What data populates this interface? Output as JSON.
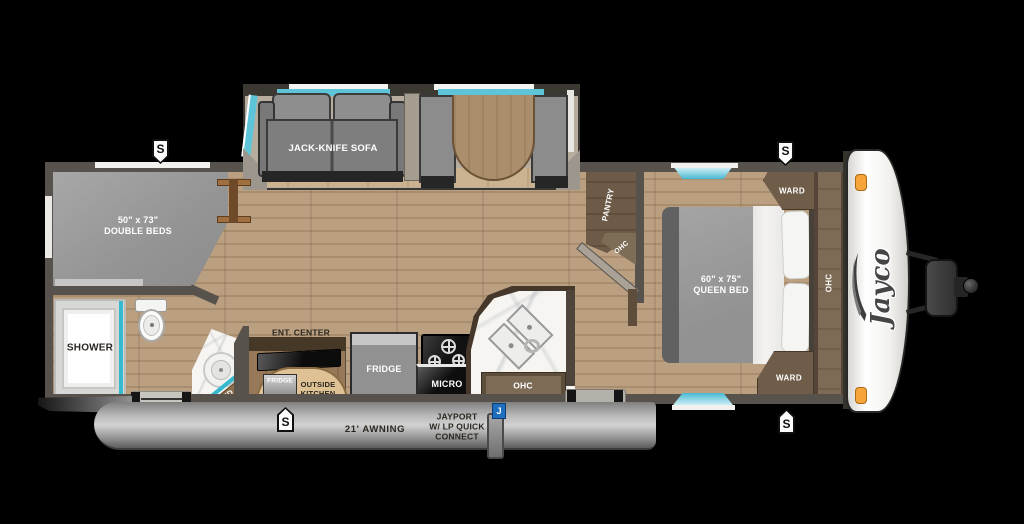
{
  "meta": {
    "title": "Jayco travel trailer floor plan"
  },
  "colors": {
    "window_teal": "#58c3d6",
    "marker_orange": "#f5a53a",
    "badge_blue": "#1e6fbd",
    "wall_gray": "#57534c",
    "floor_wood": "#b3977a",
    "awning_gray": "#9b9b9b",
    "cap_white": "#f7f6f3"
  },
  "labels": {
    "sofa": "JACK-KNIFE SOFA",
    "double_bed_size": "50\" x 73\"",
    "double_bed_name": "DOUBLE BEDS",
    "shower": "SHOWER",
    "med": "MED",
    "ent_center": "ENT. CENTER",
    "outside_fridge": "FRIDGE",
    "outside_kitchen_1": "OUTSIDE",
    "outside_kitchen_2": "KITCHEN",
    "fridge": "FRIDGE",
    "micro": "MICRO",
    "kitchen_ohc": "OHC",
    "pantry": "PANTRY",
    "pantry_ohc": "OHC",
    "queen_bed_size": "60\" x 75\"",
    "queen_bed_name": "QUEEN BED",
    "ward_top": "WARD",
    "ward_bottom": "WARD",
    "bedroom_ohc": "OHC",
    "awning": "21' AWNING",
    "jayport_1": "JAYPORT",
    "jayport_2": "W/ LP QUICK",
    "jayport_3": "CONNECT",
    "brand": "Jayco",
    "speaker_badge": "S",
    "jayport_badge": "J"
  }
}
